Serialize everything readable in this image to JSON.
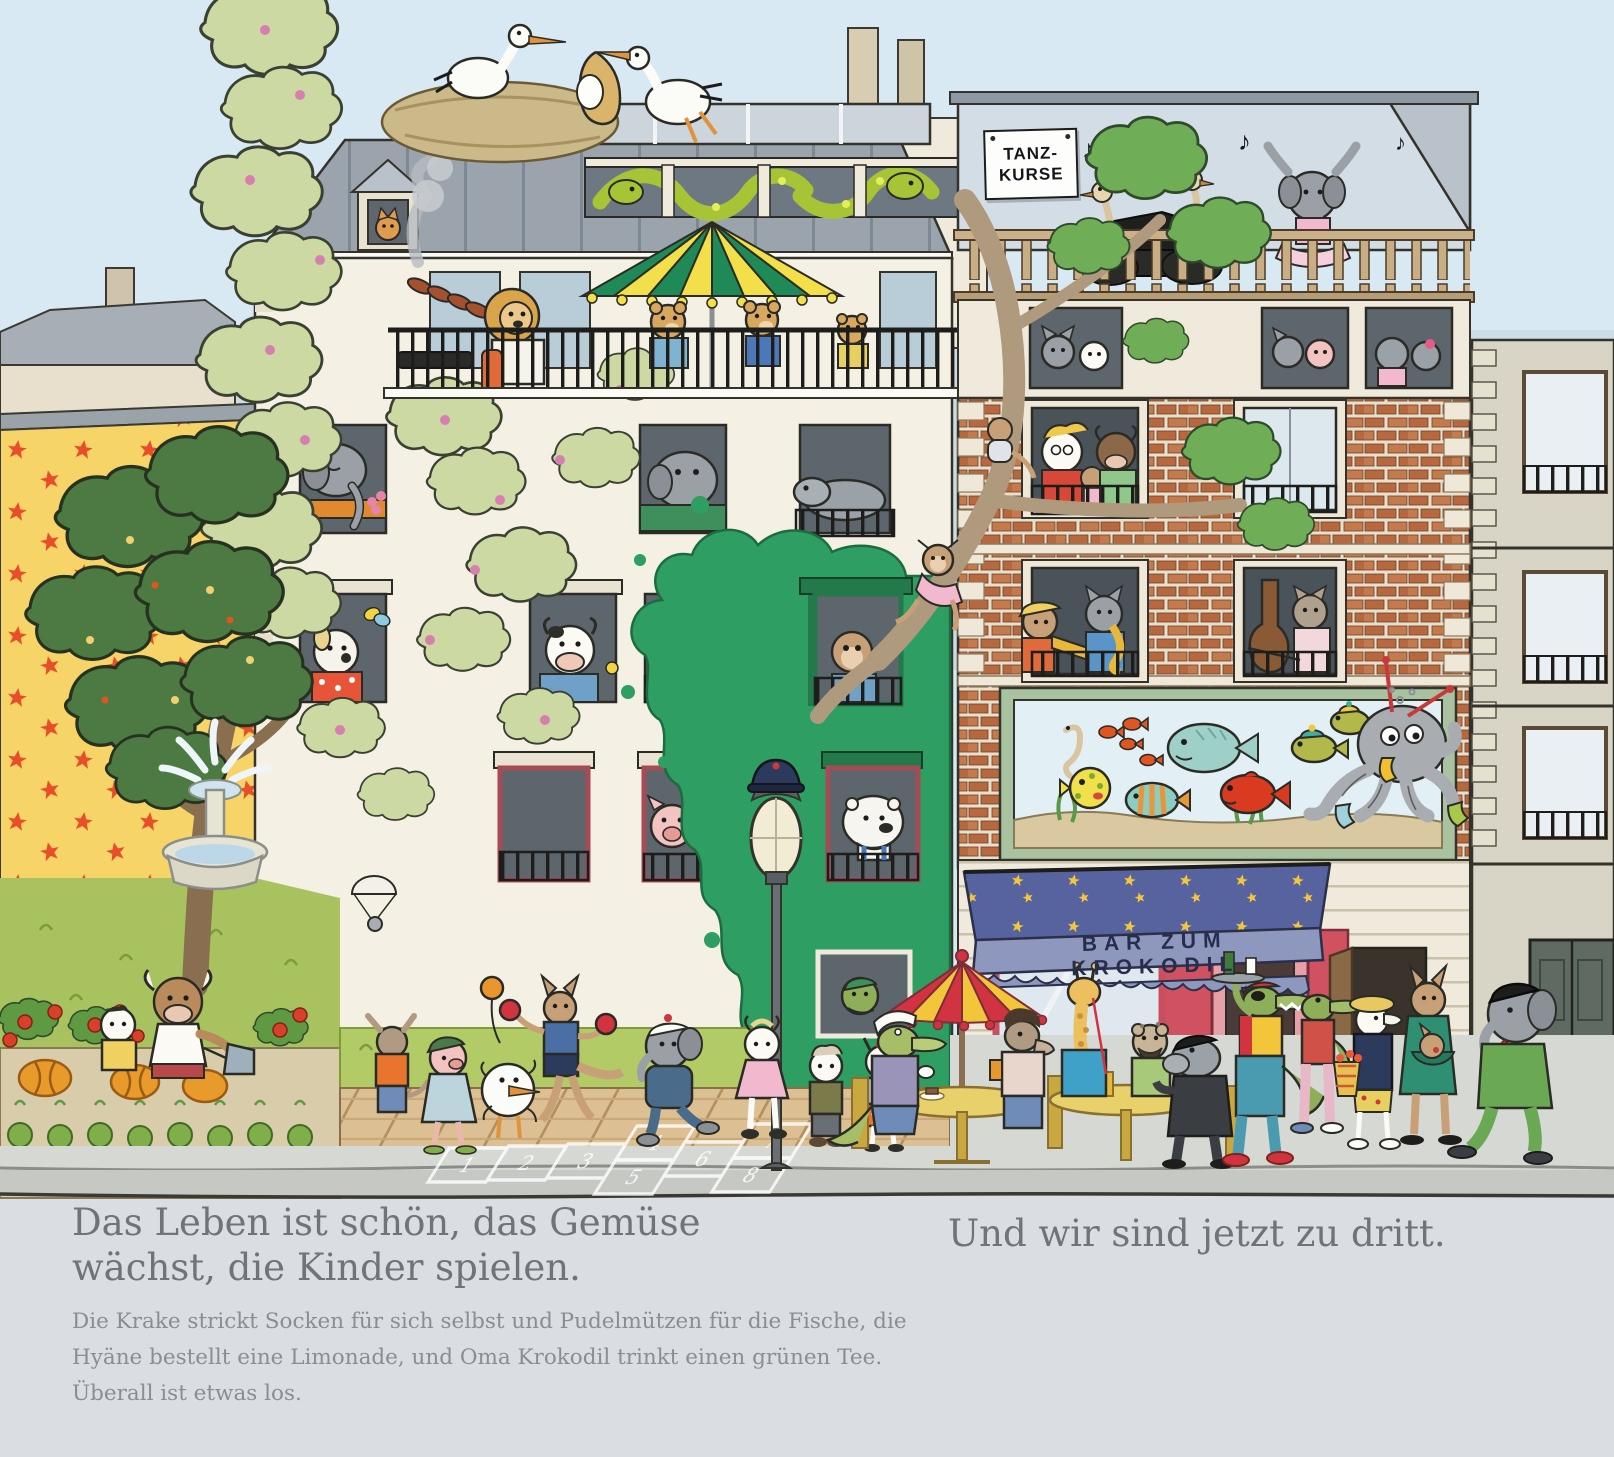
{
  "signs": {
    "dance": {
      "line1": "TANZ-",
      "line2": "KURSE"
    },
    "awning": "BAR ZUM KROKODIL"
  },
  "caption": {
    "heading1": "Das Leben ist schön, das Gemüse",
    "heading2": "wächst, die Kinder spielen.",
    "body1": "Die Krake strickt Socken für sich selbst und Pudelmützen für die Fische, die",
    "body2": "Hyäne bestellt eine Limonade, und Oma Krokodil trinkt einen grünen Tee.",
    "body3": "Überall ist etwas los.",
    "right": "Und wir sind jetzt zu dritt."
  },
  "hopscotch": {
    "c1": "1",
    "c2": "2",
    "c3": "3",
    "c4": "4",
    "c5": "5",
    "c6": "6",
    "c7": "7",
    "c8": "8"
  },
  "music_notes": {
    "n1": "♪",
    "n2": "♫",
    "n3": "♪",
    "n4": "♫",
    "n5": "♪"
  },
  "palette": {
    "sky": "#d8e9f3",
    "page_strip": "#dadde1",
    "yellow_wall": "#f7d468",
    "star_red": "#e84f28",
    "left_building": "#f4f1e4",
    "roof_grey": "#9ba4ad",
    "green_splash": "#2e9e62",
    "brick": "#b8683f",
    "awning_blue": "#56639e",
    "awning_star": "#f2c53a",
    "valance": "#8e98bf",
    "bar_red": "#d05160",
    "lawn": "#a9c260",
    "deck": "#dcbf92",
    "sidewalk": "#d6d8d3",
    "parasol_green": "#1f8a58",
    "parasol_yellow": "#f2df49",
    "cafe_parasol_red": "#d23340",
    "aquarium_frame": "#a9c3a0",
    "water": "#e2f0f6",
    "octopus": "#a9adb2",
    "snake": "#a6c436"
  }
}
